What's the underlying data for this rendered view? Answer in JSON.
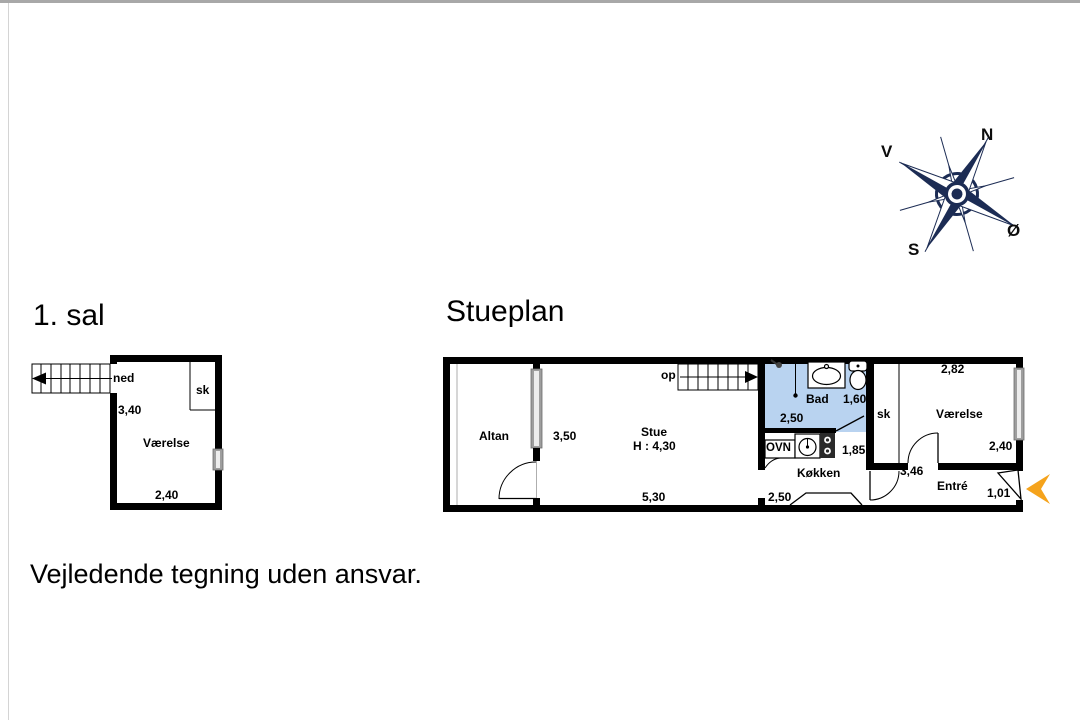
{
  "titles": {
    "first_floor": "1. sal",
    "ground_floor": "Stueplan"
  },
  "footer": {
    "disclaimer": "Vejledende tegning uden ansvar."
  },
  "compass": {
    "north": "N",
    "east": "Ø",
    "south": "S",
    "west": "V"
  },
  "first_floor": {
    "stairs": "ned",
    "room": "Værelse",
    "closet": "sk",
    "dim_depth": "3,40",
    "dim_width": "2,40"
  },
  "ground_floor": {
    "stairs": "op",
    "balcony": "Altan",
    "balcony_depth": "3,50",
    "living_room": "Stue",
    "ceiling_height": "H : 4,30",
    "living_width": "5,30",
    "bathroom": "Bad",
    "bathroom_depth": "1,60",
    "bathroom_width": "2,50",
    "oven": "OVN",
    "kitchen": "Køkken",
    "kitchen_depth": "1,85",
    "kitchen_width": "2,50",
    "closet": "sk",
    "bedroom": "Værelse",
    "bedroom_width": "2,82",
    "bedroom_depth": "2,40",
    "hall": "Entré",
    "hall_width": "3,46",
    "entry_width": "1,01"
  },
  "colors": {
    "bathroom_fill": "#b9d3f0",
    "nav_arrow": "#f5a31c",
    "compass": "#1c2c54",
    "wall": "#000000"
  }
}
